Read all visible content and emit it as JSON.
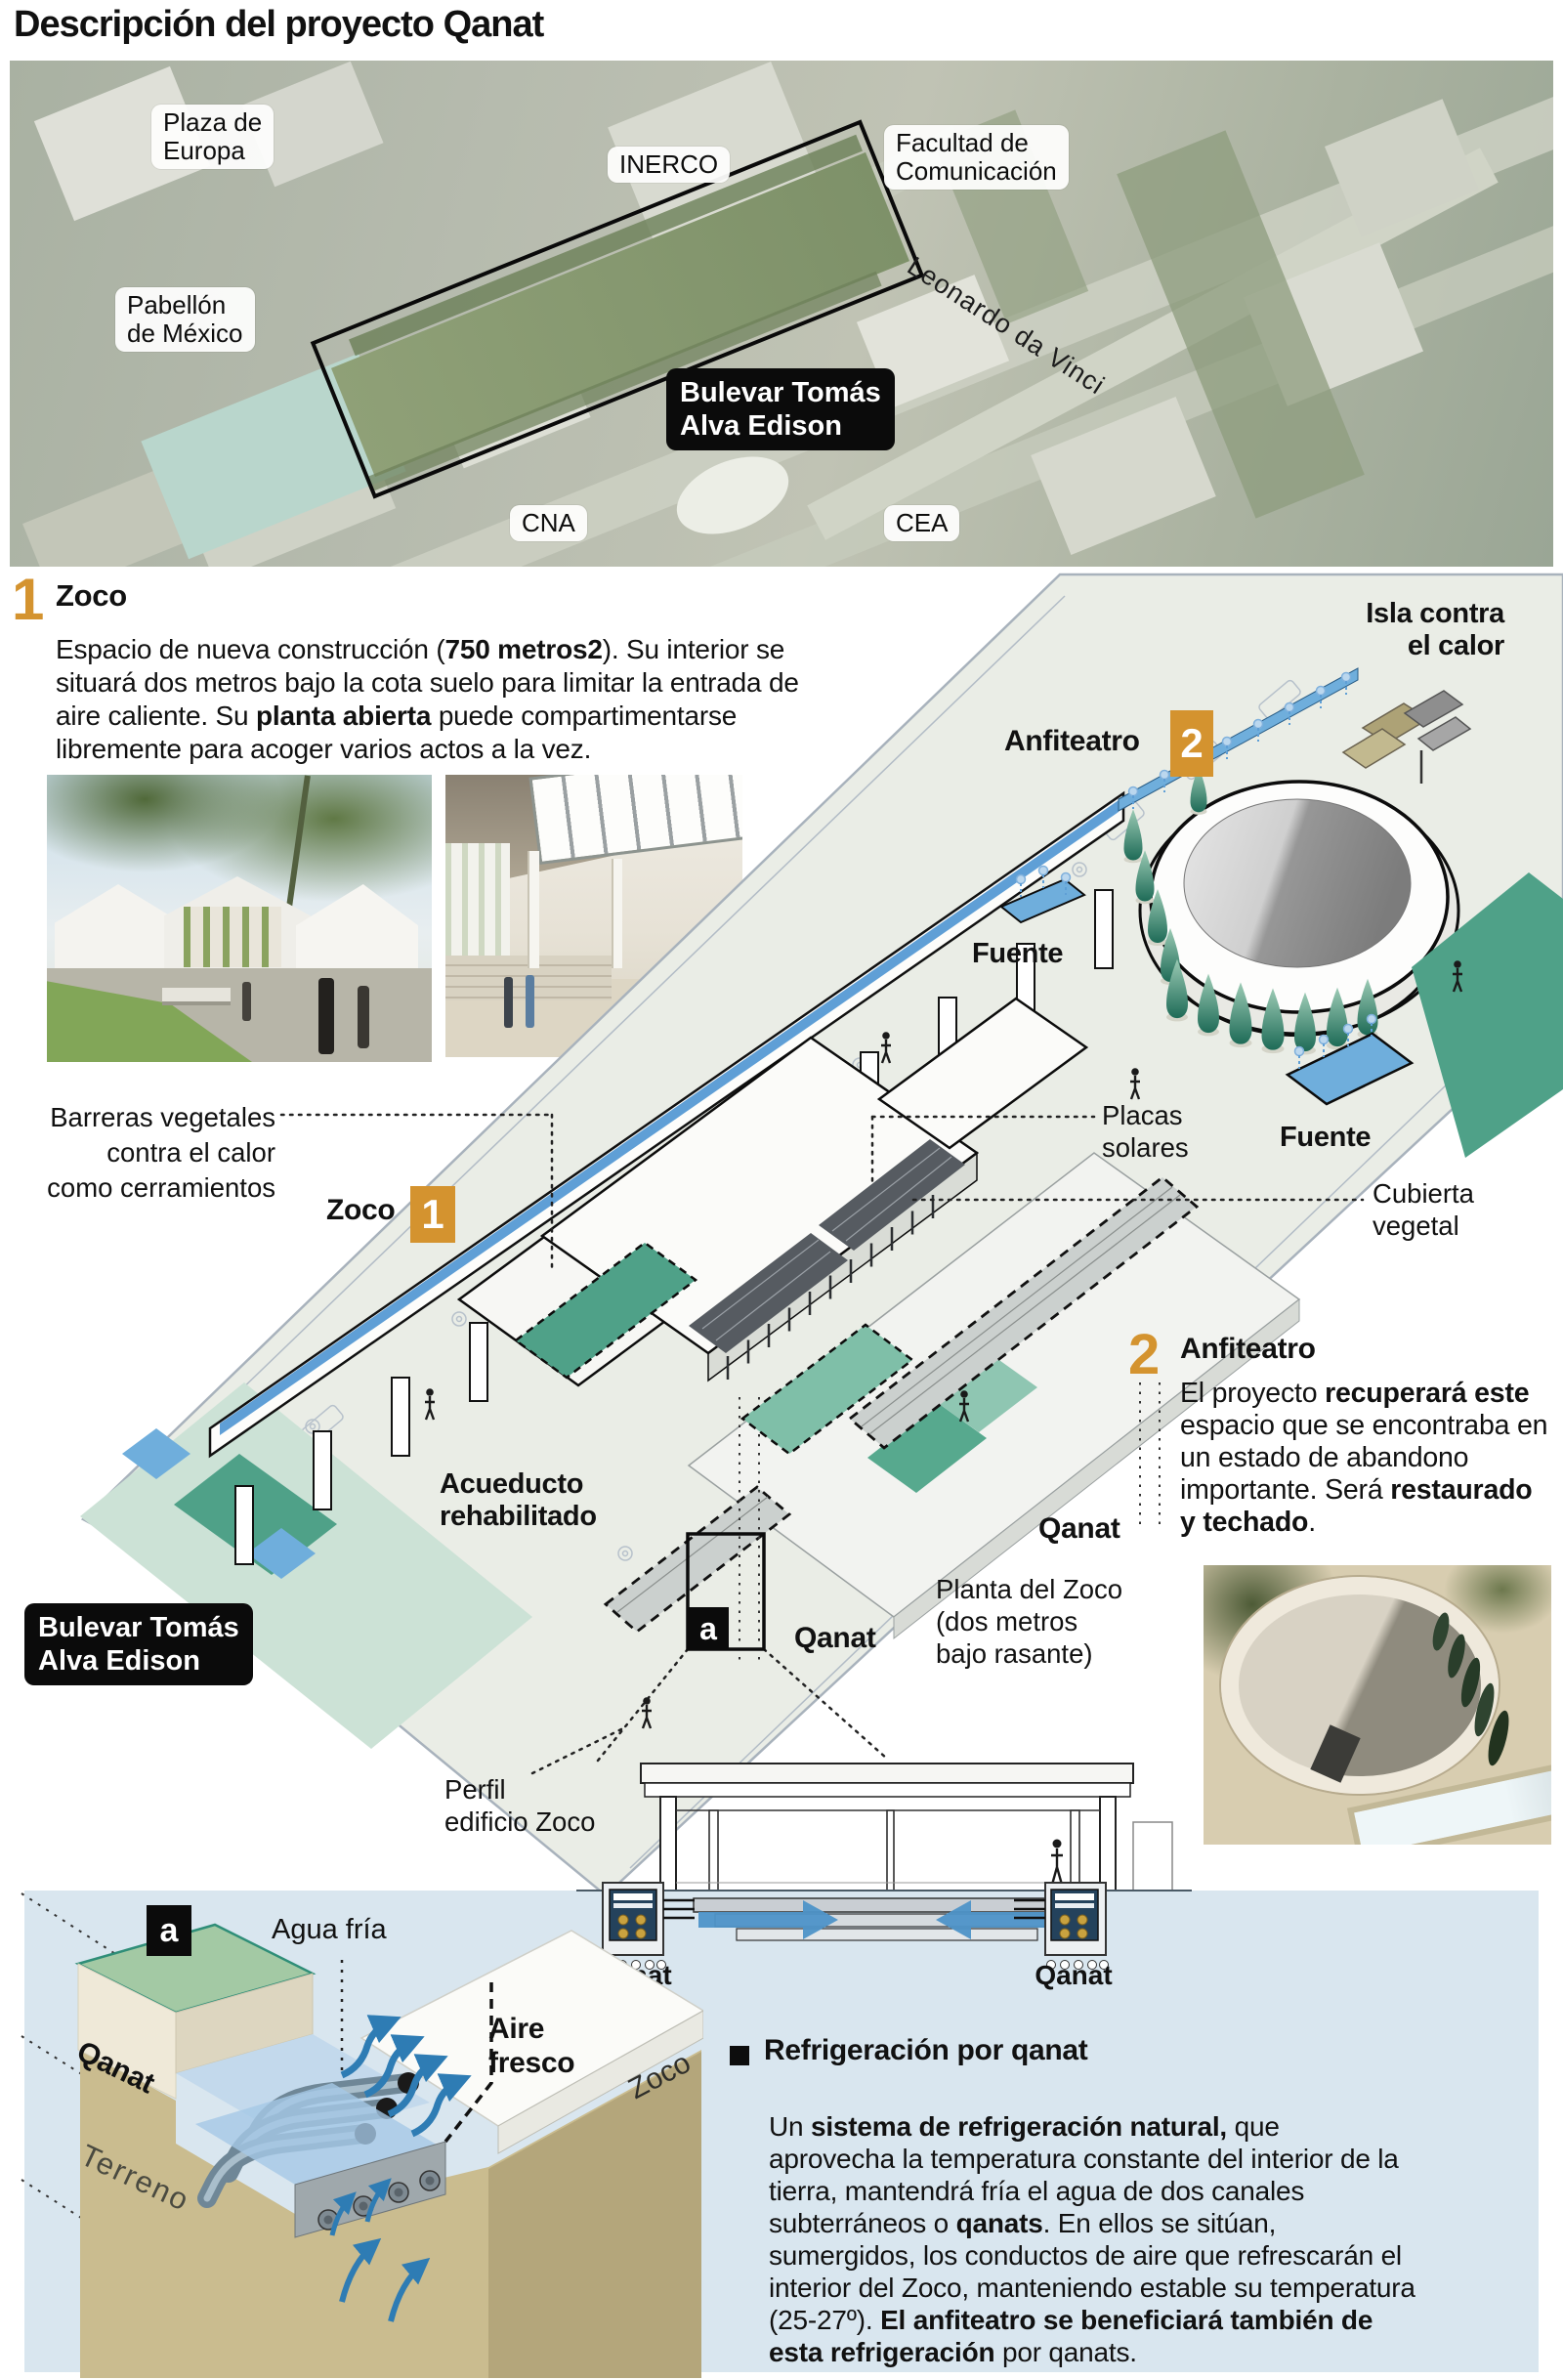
{
  "title": "Descripción del proyecto Qanat",
  "colors": {
    "accent": "#D4932F",
    "panel": "#D9E6EF",
    "teal": "#4FA188",
    "water": "#6FAEDC",
    "black_label": "#0b0b0b"
  },
  "aerial": {
    "plaza": "Plaza de\nEuropa",
    "inerco": "INERCO",
    "facultad": "Facultad de\nComunicación",
    "pabellon": "Pabellón\nde México",
    "bulevar": "Bulevar Tomás\nAlva Edison",
    "leonardo": "Leonardo da Vinci",
    "cna": "CNA",
    "cea": "CEA"
  },
  "section1": {
    "number": "1",
    "heading": "Zoco",
    "body": [
      {
        "t": "Espacio de nueva construcción ("
      },
      {
        "t": "750 metros2",
        "b": true
      },
      {
        "t": "). Su interior se\nsituará dos metros bajo la cota suelo para limitar la entrada de\naire caliente. Su "
      },
      {
        "t": "planta abierta",
        "b": true
      },
      {
        "t": " puede compartimentarse\nlibremente para acoger varios actos a la vez."
      }
    ]
  },
  "diagram": {
    "is la_note": "",
    "isla": "Isla contra\nel calor",
    "anfiteatro": "Anfiteatro",
    "num2": "2",
    "fuente_top": "Fuente",
    "placas": "Placas\nsolares",
    "fuente_right": "Fuente",
    "cubierta": "Cubierta\nvegetal",
    "barreras": "Barreras vegetales\ncontra el calor\ncomo cerramientos",
    "zoco": "Zoco",
    "num1": "1",
    "acueducto": "Acueducto\nrehabilitado",
    "bulevar": "Bulevar Tomás\nAlva Edison",
    "qanat_right": "Qanat",
    "planta": "Planta del Zoco\n(dos metros\nbajo rasante)",
    "a": "a",
    "qanat_left": "Qanat",
    "perfil": "Perfil\nedificio Zoco"
  },
  "section2": {
    "number": "2",
    "heading": "Anfiteatro",
    "body": [
      {
        "t": "El proyecto "
      },
      {
        "t": "recuperará este",
        "b": true
      },
      {
        "t": "\nespacio que se encontraba en\nun estado de abandono\nimportante. Será "
      },
      {
        "t": "restaurado\ny techado",
        "b": true
      },
      {
        "t": "."
      }
    ]
  },
  "cross_section": {
    "qanat_left": "Qanat",
    "qanat_right": "Qanat"
  },
  "cutaway": {
    "a": "a",
    "agua": "Agua fría",
    "aire": "Aire\nfresco",
    "qanat": "Qanat",
    "zoco": "Zoco",
    "terreno": "Terreno"
  },
  "refrigeracion": {
    "heading": "Refrigeración por qanat",
    "body": [
      {
        "t": "Un "
      },
      {
        "t": "sistema de refrigeración natural,",
        "b": true
      },
      {
        "t": " que\naprovecha la temperatura constante del interior de la\ntierra, mantendrá fría el agua de dos canales\nsubterráneos o "
      },
      {
        "t": "qanats",
        "b": true
      },
      {
        "t": ". En ellos se sitúan,\nsumergidos, los conductos de aire que refrescarán el\ninterior del Zoco, manteniendo estable su temperatura\n(25-27º). "
      },
      {
        "t": "El anfiteatro se beneficiará también de\nesta refrigeración",
        "b": true
      },
      {
        "t": " por qanats."
      }
    ]
  }
}
